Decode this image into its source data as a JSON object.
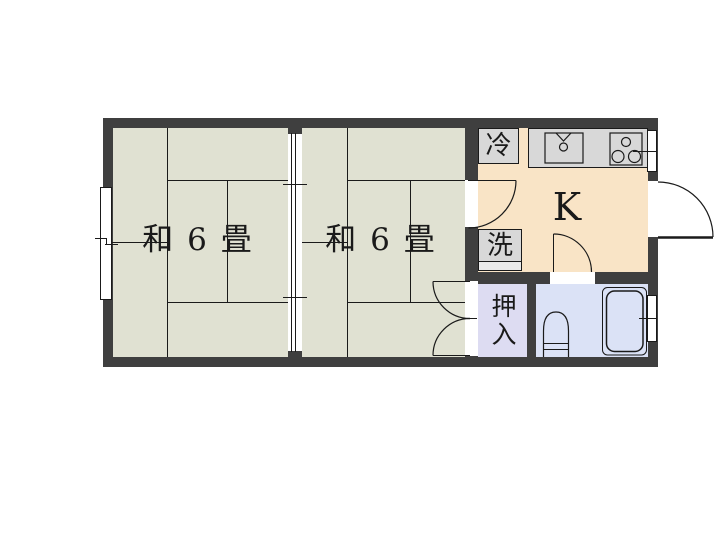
{
  "colors": {
    "wall": "#3f3f3f",
    "tatami": "#e0e1d2",
    "kitchen": "#f9e4c6",
    "closet": "#dddcf2",
    "bath": "#dbe2f6",
    "fixture": "#d8d8d8",
    "line": "#1a1a1a"
  },
  "rooms": {
    "room1": {
      "label": "和 6 畳"
    },
    "room2": {
      "label": "和 6 畳"
    },
    "kitchen": {
      "label": "K"
    },
    "closet": {
      "label": "押入"
    },
    "fridge": {
      "label": "冷"
    },
    "laundry": {
      "label": "洗"
    }
  }
}
